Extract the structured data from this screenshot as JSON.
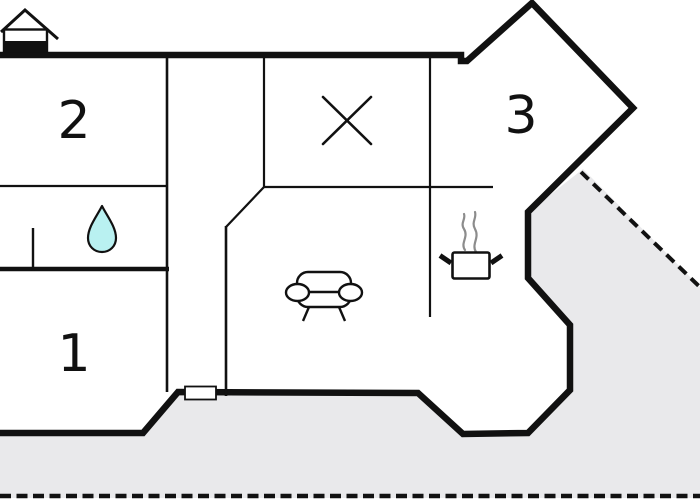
{
  "plan": {
    "rooms": [
      {
        "id": "room-1",
        "label": "1"
      },
      {
        "id": "room-2",
        "label": "2"
      },
      {
        "id": "room-3",
        "label": "3"
      }
    ],
    "icons": {
      "house": "house-icon",
      "water_drop": "water-drop-icon",
      "sofa": "sofa-icon",
      "cooking_pot": "cooking-pot-icon",
      "steam": "steam-icon",
      "x_mark": "x-mark-icon",
      "door_marker": "door-window-marker"
    },
    "colors": {
      "wall": "#111111",
      "terrace": "#e9e9eb",
      "water": "#b9f1f1",
      "steam": "#8c8c8c",
      "background": "#ffffff"
    }
  }
}
